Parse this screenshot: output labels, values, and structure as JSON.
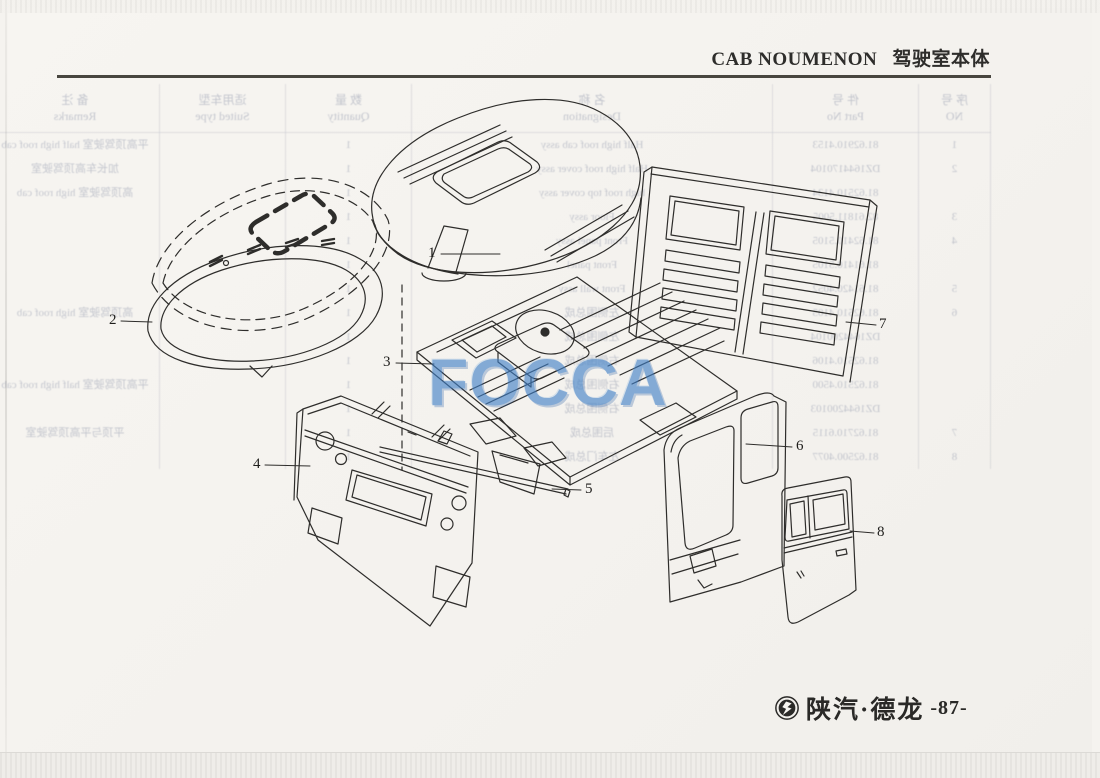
{
  "header": {
    "title_en": "CAB NOUMENON",
    "title_zh": "驾驶室本体"
  },
  "watermark": {
    "text": "FOCCA",
    "color": "#3f7fc6"
  },
  "diagram": {
    "description": "exploded view of cab body shell",
    "labels": [
      "1",
      "2",
      "3",
      "4",
      "5",
      "6",
      "7",
      "8"
    ]
  },
  "bleedthrough": {
    "note": "faint mirrored show-through of the parts table printed on the reverse page",
    "columns": [
      {
        "zh": "序 号",
        "en": "NO"
      },
      {
        "zh": "件 号",
        "en": "Part No"
      },
      {
        "zh": "名 称",
        "en": "Designation"
      },
      {
        "zh": "数 量",
        "en": "Quantity"
      },
      {
        "zh": "适用车型",
        "en": "Suited type"
      },
      {
        "zh": "备 注",
        "en": "Remarks"
      }
    ],
    "rows": [
      [
        "1",
        "81.62910.4153",
        "Half high roof cab assy",
        "1",
        "",
        "平高顶驾驶室 half high roof cab"
      ],
      [
        "2",
        "DZ1644170104",
        "Half high roof cover assy",
        "1",
        "",
        "加长车高顶驾驶室"
      ],
      [
        "",
        "81.62510.4134",
        "high roof top cover assy",
        "1",
        "",
        "高顶驾驶室 high roof cab"
      ],
      [
        "3",
        "82.61811.5005",
        "Floor assy",
        "1",
        "",
        ""
      ],
      [
        "4",
        "81.62410.5105",
        "Front panel assy",
        "1",
        "",
        ""
      ],
      [
        "",
        "81.61410.5105",
        "Front panel",
        "1",
        "",
        ""
      ],
      [
        "5",
        "81.61420.4052",
        "Front wall assy",
        "1",
        "",
        ""
      ],
      [
        "6",
        "81.62510.4105",
        "左侧围总成",
        "1",
        "",
        "高顶驾驶室 high roof cab"
      ],
      [
        "",
        "DZ1644200104",
        "左侧围总成",
        "1",
        "",
        ""
      ],
      [
        "",
        "81.62510.4106",
        "右侧围总成",
        "1",
        "",
        ""
      ],
      [
        "",
        "81.62510.4500",
        "右侧围总成",
        "1",
        "",
        "平高顶驾驶室 half high roof cab"
      ],
      [
        "",
        "DZ1644200103",
        "右侧围总成",
        "1",
        "",
        ""
      ],
      [
        "7",
        "81.62710.6115",
        "后围总成",
        "1",
        "",
        "平顶与平高顶驾驶室"
      ],
      [
        "8",
        "81.62500.4077",
        "左车门总成",
        "1",
        "",
        ""
      ]
    ]
  },
  "footer": {
    "brand": "陕汽·德龙",
    "page_number": "-87-"
  }
}
